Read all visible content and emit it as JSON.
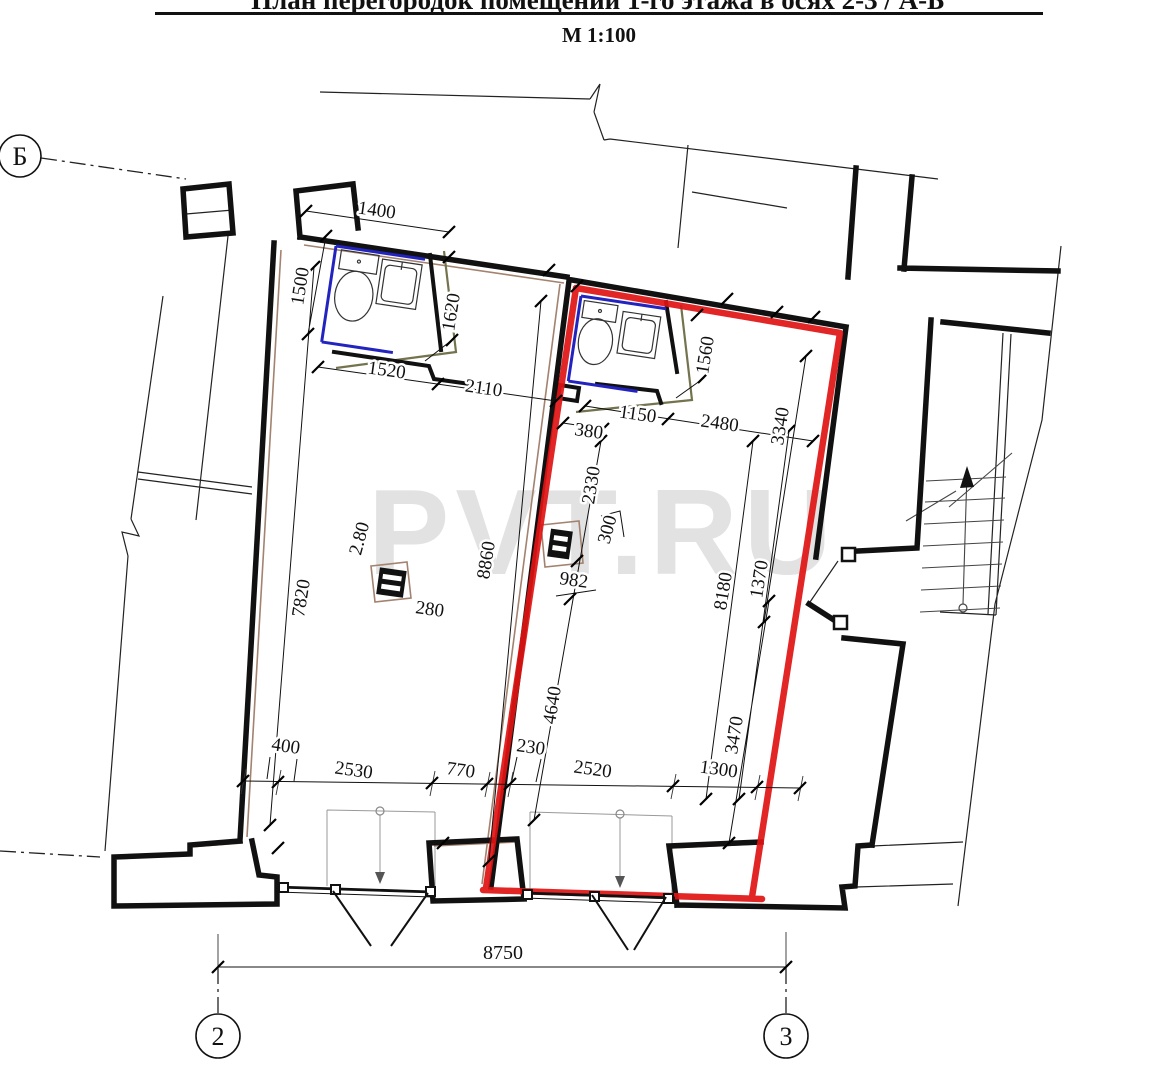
{
  "title": {
    "heading_clipped": "План перегородок помещений 1-го этажа в осях  2-3 / А-Б",
    "scale": "М 1:100"
  },
  "watermark": {
    "text": "PVT.RU"
  },
  "axes": {
    "horizontal": "Б",
    "vertical_left": "2",
    "vertical_right": "3"
  },
  "dims": {
    "notch_width": "1400",
    "wc1_height": "1500",
    "wc1_width": "1520",
    "room1_top": "2110",
    "wc1_depth": "1620",
    "wc2_depth": "1560",
    "wc2_width": "1150",
    "room2_top": "2480",
    "room2_right_top": "3340",
    "partition_gap": "380",
    "left_seg1": "2330",
    "pilaster": "300",
    "room1_depth": "8860",
    "pilaster_offset": "982",
    "room2_depth": "8180",
    "room2_right_offset": "1370",
    "room1_left_depth": "7820",
    "column_side_v": "2.80",
    "column_side_h": "280",
    "left_seg2": "4640",
    "room2_right_bottom": "3470",
    "pier_left": "400",
    "shopfront1": "2530",
    "pier_mid": "770",
    "wall_mid": "230",
    "shopfront2": "2520",
    "pier_right": "1300",
    "axis_span": "8750"
  },
  "colors": {
    "highlight": "#e01414",
    "fixture": "#2323c0",
    "partition": "#73734d",
    "finish": "#a3826f",
    "watermark": "#dcdcdc",
    "wall": "#111111"
  }
}
